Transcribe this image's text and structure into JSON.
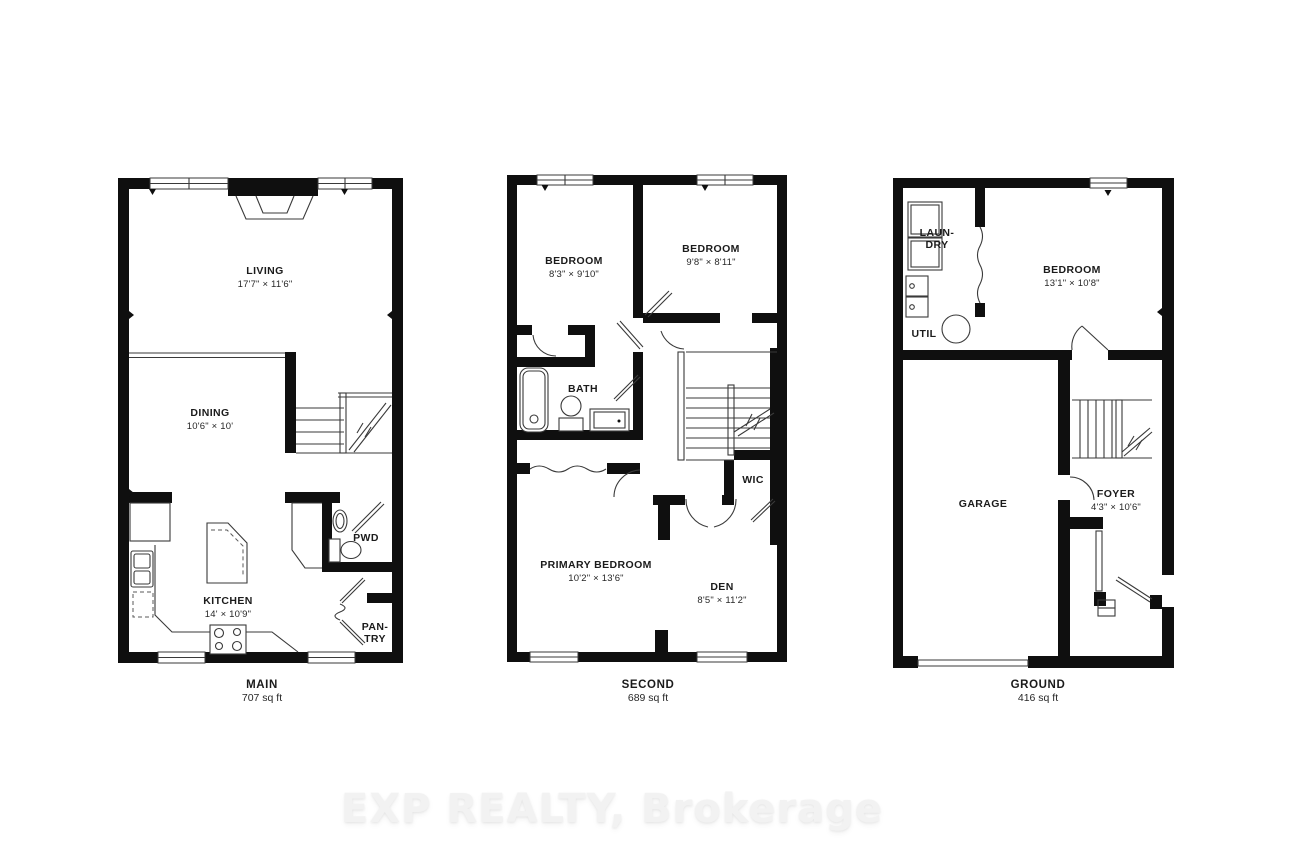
{
  "watermark": "EXP REALTY, Brokerage",
  "floors": {
    "main": {
      "name": "MAIN",
      "area": "707 sq ft",
      "rooms": {
        "living": {
          "name": "LIVING",
          "dims": "17'7\" × 11'6\""
        },
        "dining": {
          "name": "DINING",
          "dims": "10'6\" × 10'"
        },
        "kitchen": {
          "name": "KITCHEN",
          "dims": "14' × 10'9\""
        },
        "pwd": {
          "name": "PWD"
        },
        "pantry": {
          "line1": "PAN-",
          "line2": "TRY"
        }
      }
    },
    "second": {
      "name": "SECOND",
      "area": "689 sq ft",
      "rooms": {
        "bedroom1": {
          "name": "BEDROOM",
          "dims": "8'3\" × 9'10\""
        },
        "bedroom2": {
          "name": "BEDROOM",
          "dims": "9'8\" × 8'11\""
        },
        "bath": {
          "name": "BATH"
        },
        "primary": {
          "name": "PRIMARY BEDROOM",
          "dims": "10'2\" × 13'6\""
        },
        "den": {
          "name": "DEN",
          "dims": "8'5\" × 11'2\""
        },
        "wic": {
          "name": "WIC"
        }
      }
    },
    "ground": {
      "name": "GROUND",
      "area": "416 sq ft",
      "rooms": {
        "laundry": {
          "line1": "LAUN-",
          "line2": "DRY"
        },
        "util": {
          "name": "UTIL"
        },
        "bedroom": {
          "name": "BEDROOM",
          "dims": "13'1\" × 10'8\""
        },
        "garage": {
          "name": "GARAGE"
        },
        "foyer": {
          "name": "FOYER",
          "dims": "4'3\" × 10'6\""
        }
      }
    }
  }
}
